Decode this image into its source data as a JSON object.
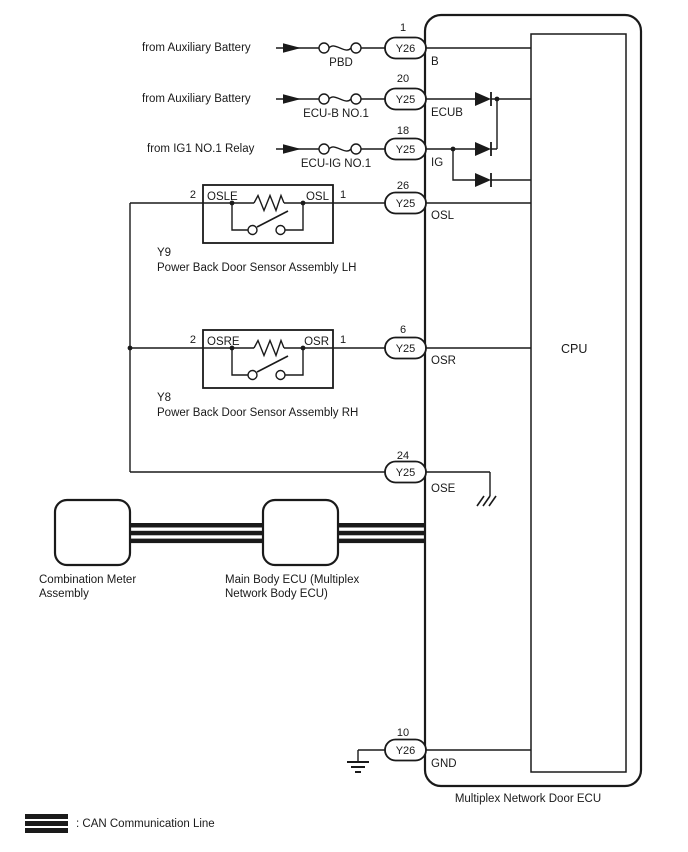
{
  "power_rows": [
    {
      "source": "from Auxiliary Battery",
      "fuse": "PBD",
      "pin": "1",
      "connector": "Y26",
      "terminal": "B"
    },
    {
      "source": "from Auxiliary Battery",
      "fuse": "ECU-B NO.1",
      "pin": "20",
      "connector": "Y25",
      "terminal": "ECUB"
    },
    {
      "source": "from IG1 NO.1 Relay",
      "fuse": "ECU-IG NO.1",
      "pin": "18",
      "connector": "Y25",
      "terminal": "IG"
    }
  ],
  "sensors": [
    {
      "code": "Y9",
      "name": "Power Back Door Sensor Assembly LH",
      "pin_left": "2",
      "pin_right": "1",
      "terminal_left": "OSLE",
      "terminal_right": "OSL",
      "connector_pin": "26",
      "connector": "Y25",
      "ecu_terminal": "OSL"
    },
    {
      "code": "Y8",
      "name": "Power Back Door Sensor Assembly RH",
      "pin_left": "2",
      "pin_right": "1",
      "terminal_left": "OSRE",
      "terminal_right": "OSR",
      "connector_pin": "6",
      "connector": "Y25",
      "ecu_terminal": "OSR"
    }
  ],
  "ose": {
    "pin": "24",
    "connector": "Y25",
    "terminal": "OSE"
  },
  "gnd": {
    "pin": "10",
    "connector": "Y26",
    "terminal": "GND"
  },
  "ecu": {
    "cpu": "CPU",
    "label": "Multiplex Network Door ECU"
  },
  "can_nodes": [
    {
      "line1": "Combination Meter",
      "line2": "Assembly"
    },
    {
      "line1": "Main Body ECU (Multiplex",
      "line2": "Network Body ECU)"
    }
  ],
  "legend": {
    "label": ": CAN Communication Line"
  }
}
